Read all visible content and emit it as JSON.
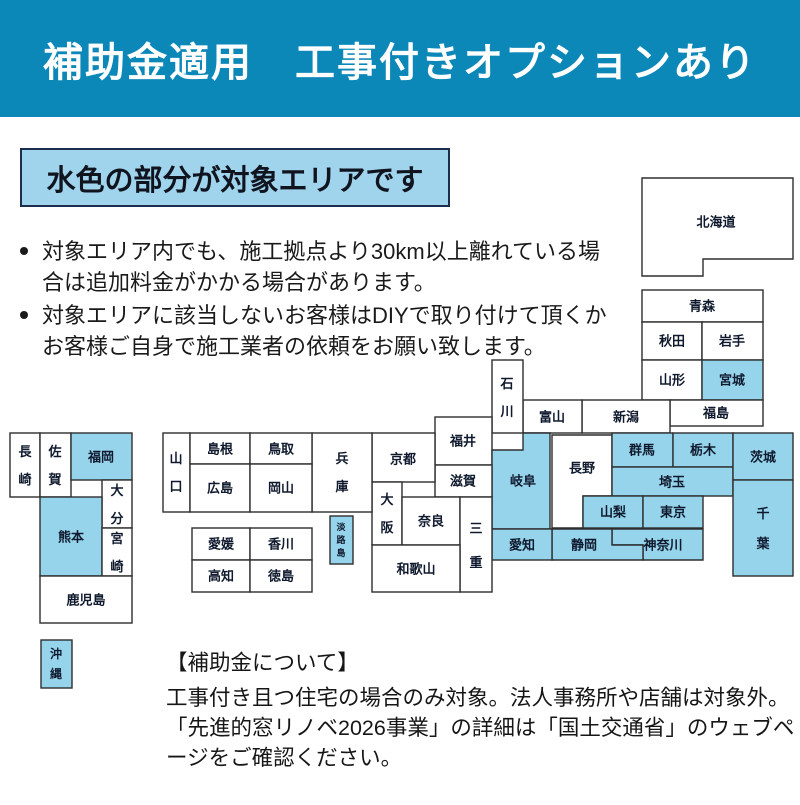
{
  "banner": {
    "title": "補助金適用　工事付きオプションあり"
  },
  "area_box": {
    "label": "水色の部分が対象エリアです"
  },
  "bullets": [
    "対象エリア内でも、施工拠点より30km以上離れている場合は追加料金がかかる場合があります。",
    "対象エリアに該当しないお客様はDIYで取り付けて頂くかお客様ご自身で施工業者の依頼をお願い致します。"
  ],
  "footer": {
    "heading": "【補助金について】",
    "lines": [
      "工事付き且つ住宅の場合のみ対象。法人事務所や店舗は対象外。",
      "「先進的窓リノベ2026事業」の詳細は「国土交通省」のウェブページをご確認ください。"
    ]
  },
  "colors": {
    "banner_bg": "#0b87b8",
    "area_box_bg": "#a0d3ec",
    "highlight": "#96d4ec",
    "white_cell": "#ffffff",
    "border": "#2e2e2e",
    "map_text": "#101a2e"
  },
  "map": {
    "highlight_meaning": "対象エリア（水色）",
    "prefectures": [
      {
        "name": "北海道",
        "points": [
          [
            642,
            178
          ],
          [
            793,
            178
          ],
          [
            793,
            259
          ],
          [
            703,
            259
          ],
          [
            703,
            276
          ],
          [
            642,
            276
          ]
        ],
        "label": [
          716,
          222
        ],
        "highlighted": false
      },
      {
        "name": "青森",
        "x": 642,
        "y": 290,
        "w": 121,
        "h": 32,
        "label": [
          702,
          306
        ],
        "highlighted": false
      },
      {
        "name": "秋田",
        "x": 642,
        "y": 322,
        "w": 60,
        "h": 38,
        "label": [
          672,
          341
        ],
        "highlighted": false
      },
      {
        "name": "岩手",
        "x": 702,
        "y": 322,
        "w": 61,
        "h": 38,
        "label": [
          732,
          341
        ],
        "highlighted": false
      },
      {
        "name": "山形",
        "x": 642,
        "y": 360,
        "w": 60,
        "h": 40,
        "label": [
          672,
          380
        ],
        "highlighted": false
      },
      {
        "name": "宮城",
        "x": 702,
        "y": 360,
        "w": 61,
        "h": 40,
        "label": [
          732,
          380
        ],
        "highlighted": true
      },
      {
        "name": "福島",
        "x": 670,
        "y": 400,
        "w": 93,
        "h": 26,
        "label": [
          716,
          413
        ],
        "highlighted": false
      },
      {
        "name": "新潟",
        "x": 582,
        "y": 400,
        "w": 88,
        "h": 33,
        "label": [
          626,
          417
        ],
        "highlighted": false
      },
      {
        "name": "富山",
        "x": 523,
        "y": 400,
        "w": 59,
        "h": 33,
        "label": [
          552,
          417
        ],
        "highlighted": false
      },
      {
        "name": "石川",
        "x": 492,
        "y": 360,
        "w": 31,
        "h": 73,
        "label": [
          507,
          397
        ],
        "highlighted": false,
        "vertical": true
      },
      {
        "name": "福井",
        "x": 435,
        "y": 417,
        "w": 57,
        "h": 48,
        "label": [
          463,
          441
        ],
        "highlighted": false
      },
      {
        "name": "岐阜",
        "points": [
          [
            523,
            433
          ],
          [
            550,
            433
          ],
          [
            550,
            529
          ],
          [
            492,
            529
          ],
          [
            492,
            450
          ],
          [
            523,
            450
          ]
        ],
        "label": [
          523,
          481
        ],
        "highlighted": true
      },
      {
        "name": "長野",
        "points": [
          [
            552,
            435
          ],
          [
            612,
            435
          ],
          [
            612,
            496
          ],
          [
            583,
            496
          ],
          [
            583,
            528
          ],
          [
            552,
            528
          ]
        ],
        "label": [
          582,
          468
        ],
        "highlighted": false
      },
      {
        "name": "群馬",
        "x": 612,
        "y": 433,
        "w": 61,
        "h": 34,
        "label": [
          642,
          450
        ],
        "highlighted": true
      },
      {
        "name": "栃木",
        "x": 673,
        "y": 433,
        "w": 60,
        "h": 34,
        "label": [
          703,
          450
        ],
        "highlighted": true
      },
      {
        "name": "埼玉",
        "x": 612,
        "y": 467,
        "w": 121,
        "h": 29,
        "label": [
          672,
          482
        ],
        "highlighted": true
      },
      {
        "name": "茨城",
        "x": 733,
        "y": 433,
        "w": 60,
        "h": 47,
        "label": [
          763,
          457
        ],
        "highlighted": true
      },
      {
        "name": "千葉",
        "x": 733,
        "y": 480,
        "w": 60,
        "h": 96,
        "label": [
          763,
          528
        ],
        "highlighted": true,
        "vertical": true,
        "lh": 30
      },
      {
        "name": "山梨",
        "x": 583,
        "y": 496,
        "w": 60,
        "h": 32,
        "label": [
          613,
          512
        ],
        "highlighted": true
      },
      {
        "name": "東京",
        "x": 643,
        "y": 496,
        "w": 60,
        "h": 32,
        "label": [
          673,
          512
        ],
        "highlighted": true
      },
      {
        "name": "神奈川",
        "points": [
          [
            612,
            529
          ],
          [
            703,
            529
          ],
          [
            703,
            560
          ],
          [
            643,
            560
          ],
          [
            643,
            545
          ],
          [
            612,
            545
          ]
        ],
        "label": [
          663,
          545
        ],
        "highlighted": true
      },
      {
        "name": "静岡",
        "points": [
          [
            552,
            529
          ],
          [
            612,
            529
          ],
          [
            612,
            545
          ],
          [
            643,
            545
          ],
          [
            643,
            560
          ],
          [
            552,
            560
          ]
        ],
        "label": [
          584,
          545
        ],
        "highlighted": true
      },
      {
        "name": "愛知",
        "x": 492,
        "y": 529,
        "w": 60,
        "h": 31,
        "label": [
          522,
          545
        ],
        "highlighted": true
      },
      {
        "name": "滋賀",
        "x": 435,
        "y": 465,
        "w": 57,
        "h": 32,
        "label": [
          463,
          481
        ],
        "highlighted": false
      },
      {
        "name": "京都",
        "x": 372,
        "y": 433,
        "w": 63,
        "h": 49,
        "label": [
          403,
          459
        ],
        "highlighted": false
      },
      {
        "name": "大阪",
        "x": 372,
        "y": 482,
        "w": 30,
        "h": 63,
        "label": [
          387,
          513
        ],
        "highlighted": false,
        "vertical": true
      },
      {
        "name": "奈良",
        "x": 402,
        "y": 497,
        "w": 58,
        "h": 48,
        "label": [
          431,
          521
        ],
        "highlighted": false
      },
      {
        "name": "三重",
        "x": 460,
        "y": 497,
        "w": 32,
        "h": 95,
        "label": [
          476,
          545
        ],
        "highlighted": false,
        "vertical": true,
        "lh": 34
      },
      {
        "name": "和歌山",
        "x": 372,
        "y": 545,
        "w": 88,
        "h": 47,
        "label": [
          416,
          569
        ],
        "highlighted": false
      },
      {
        "name": "兵庫",
        "x": 312,
        "y": 433,
        "w": 60,
        "h": 79,
        "label": [
          342,
          472
        ],
        "highlighted": false,
        "vertical": true
      },
      {
        "name": "淡路島",
        "x": 330,
        "y": 516,
        "w": 23,
        "h": 48,
        "label": [
          341,
          540
        ],
        "highlighted": true,
        "vertical": true,
        "fs": 9,
        "lh": 13
      },
      {
        "name": "山口",
        "x": 163,
        "y": 433,
        "w": 27,
        "h": 79,
        "label": [
          176,
          472
        ],
        "highlighted": false,
        "vertical": true
      },
      {
        "name": "島根",
        "x": 190,
        "y": 433,
        "w": 60,
        "h": 31,
        "label": [
          220,
          449
        ],
        "highlighted": false
      },
      {
        "name": "鳥取",
        "x": 250,
        "y": 433,
        "w": 62,
        "h": 31,
        "label": [
          281,
          449
        ],
        "highlighted": false
      },
      {
        "name": "広島",
        "x": 190,
        "y": 464,
        "w": 60,
        "h": 48,
        "label": [
          220,
          488
        ],
        "highlighted": false
      },
      {
        "name": "岡山",
        "x": 250,
        "y": 464,
        "w": 62,
        "h": 48,
        "label": [
          281,
          488
        ],
        "highlighted": false
      },
      {
        "name": "愛媛",
        "x": 192,
        "y": 528,
        "w": 58,
        "h": 32,
        "label": [
          221,
          544
        ],
        "highlighted": false
      },
      {
        "name": "香川",
        "x": 250,
        "y": 528,
        "w": 62,
        "h": 32,
        "label": [
          281,
          544
        ],
        "highlighted": false
      },
      {
        "name": "高知",
        "x": 192,
        "y": 560,
        "w": 58,
        "h": 32,
        "label": [
          221,
          576
        ],
        "highlighted": false
      },
      {
        "name": "徳島",
        "x": 250,
        "y": 560,
        "w": 62,
        "h": 32,
        "label": [
          281,
          576
        ],
        "highlighted": false
      },
      {
        "name": "長崎",
        "x": 10,
        "y": 433,
        "w": 30,
        "h": 64,
        "label": [
          25,
          465
        ],
        "highlighted": false,
        "vertical": true
      },
      {
        "name": "佐賀",
        "x": 40,
        "y": 433,
        "w": 31,
        "h": 64,
        "label": [
          55,
          465
        ],
        "highlighted": false,
        "vertical": true
      },
      {
        "name": "福岡",
        "x": 71,
        "y": 433,
        "w": 61,
        "h": 47,
        "label": [
          101,
          457
        ],
        "highlighted": true
      },
      {
        "name": "大分",
        "x": 102,
        "y": 480,
        "w": 30,
        "h": 48,
        "label": [
          117,
          504
        ],
        "highlighted": false,
        "vertical": true
      },
      {
        "name": "熊本",
        "x": 40,
        "y": 497,
        "w": 62,
        "h": 79,
        "label": [
          71,
          537
        ],
        "highlighted": true
      },
      {
        "name": "宮崎",
        "x": 102,
        "y": 528,
        "w": 30,
        "h": 48,
        "label": [
          117,
          552
        ],
        "highlighted": false,
        "vertical": true
      },
      {
        "name": "鹿児島",
        "x": 40,
        "y": 576,
        "w": 92,
        "h": 47,
        "label": [
          86,
          600
        ],
        "highlighted": false
      },
      {
        "name": "沖縄",
        "x": 41,
        "y": 640,
        "w": 31,
        "h": 48,
        "label": [
          56,
          664
        ],
        "highlighted": true,
        "vertical": true,
        "fs": 12,
        "lh": 20
      }
    ]
  }
}
